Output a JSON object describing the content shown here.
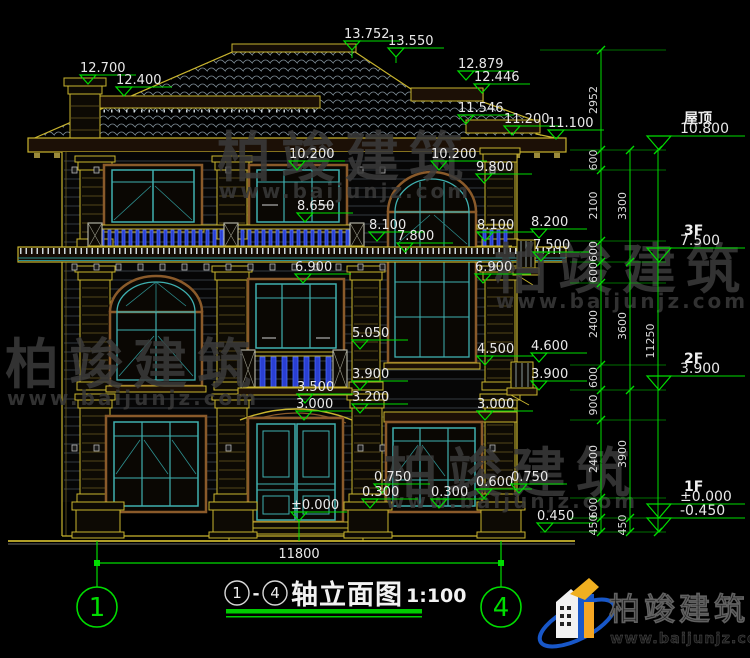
{
  "drawing": {
    "title_axis_start": "1",
    "title_axis_end": "4",
    "title_dash": "-",
    "title_text": "轴立面图",
    "scale": "1:100",
    "bottom_dimension": "11800",
    "axis_bubbles": [
      "1",
      "4"
    ]
  },
  "watermark_text": {
    "name": "柏竣建筑",
    "url": "www.baijunjz.com"
  },
  "logo": {
    "name": "柏竣建筑",
    "url": "www.baijunjz.com"
  },
  "floor_levels": [
    {
      "label": "屋顶",
      "value": "10.800",
      "y": 150
    },
    {
      "label": "3F",
      "value": "7.500",
      "y": 262
    },
    {
      "label": "2F",
      "value": "3.900",
      "y": 390
    },
    {
      "label": "1F",
      "value": "±0.000",
      "y": 518
    },
    {
      "label": "",
      "value": "-0.450",
      "y": 532
    }
  ],
  "elevation_markers": [
    {
      "value": "12.700",
      "x": 88,
      "y": 84
    },
    {
      "value": "12.400",
      "x": 124,
      "y": 96
    },
    {
      "value": "13.752",
      "x": 352,
      "y": 50,
      "tail": 8
    },
    {
      "value": "13.550",
      "x": 396,
      "y": 57,
      "tail": 6
    },
    {
      "value": "12.879",
      "x": 466,
      "y": 80
    },
    {
      "value": "12.446",
      "x": 482,
      "y": 93
    },
    {
      "value": "11.546",
      "x": 466,
      "y": 124
    },
    {
      "value": "11.200",
      "x": 512,
      "y": 135
    },
    {
      "value": "11.100",
      "x": 556,
      "y": 139
    },
    {
      "value": "10.200",
      "x": 297,
      "y": 170
    },
    {
      "value": "10.200",
      "x": 439,
      "y": 170
    },
    {
      "value": "9.800",
      "x": 484,
      "y": 183
    },
    {
      "value": "8.650",
      "x": 305,
      "y": 222
    },
    {
      "value": "8.100",
      "x": 377,
      "y": 241
    },
    {
      "value": "7.800",
      "x": 405,
      "y": 252
    },
    {
      "value": "8.100",
      "x": 485,
      "y": 241
    },
    {
      "value": "8.200",
      "x": 539,
      "y": 238
    },
    {
      "value": "7.500",
      "x": 541,
      "y": 261
    },
    {
      "value": "6.900",
      "x": 303,
      "y": 283
    },
    {
      "value": "6.900",
      "x": 483,
      "y": 283
    },
    {
      "value": "5.050",
      "x": 360,
      "y": 349
    },
    {
      "value": "3.900",
      "x": 360,
      "y": 390
    },
    {
      "value": "3.500",
      "x": 305,
      "y": 403
    },
    {
      "value": "3.200",
      "x": 360,
      "y": 413
    },
    {
      "value": "3.000",
      "x": 304,
      "y": 420
    },
    {
      "value": "4.500",
      "x": 485,
      "y": 365
    },
    {
      "value": "3.000",
      "x": 485,
      "y": 420
    },
    {
      "value": "4.600",
      "x": 539,
      "y": 362
    },
    {
      "value": "3.900",
      "x": 539,
      "y": 390
    },
    {
      "value": "0.750",
      "x": 382,
      "y": 493
    },
    {
      "value": "0.300",
      "x": 370,
      "y": 508
    },
    {
      "value": "0.300",
      "x": 439,
      "y": 508
    },
    {
      "value": "0.600",
      "x": 484,
      "y": 498
    },
    {
      "value": "0.750",
      "x": 519,
      "y": 493
    },
    {
      "value": "±0.000",
      "x": 299,
      "y": 521,
      "tail": 20
    },
    {
      "value": "0.450",
      "x": 545,
      "y": 532
    }
  ],
  "dim_chains": [
    {
      "x": 601,
      "segments": [
        {
          "label": "2952",
          "y1": 50,
          "y2": 150
        },
        {
          "label": "600",
          "y1": 150,
          "y2": 170
        },
        {
          "label": "2100",
          "y1": 170,
          "y2": 241
        },
        {
          "label": "600",
          "y1": 241,
          "y2": 262
        },
        {
          "label": "600",
          "y1": 262,
          "y2": 283
        },
        {
          "label": "2400",
          "y1": 283,
          "y2": 365
        },
        {
          "label": "600",
          "y1": 365,
          "y2": 390
        },
        {
          "label": "900",
          "y1": 390,
          "y2": 420
        },
        {
          "label": "2400",
          "y1": 420,
          "y2": 498
        },
        {
          "label": "600",
          "y1": 498,
          "y2": 518
        },
        {
          "label": "450",
          "y1": 518,
          "y2": 532
        }
      ]
    },
    {
      "x": 630,
      "segments": [
        {
          "label": "3300",
          "y1": 150,
          "y2": 262
        },
        {
          "label": "3600",
          "y1": 262,
          "y2": 390
        },
        {
          "label": "3900",
          "y1": 390,
          "y2": 518
        },
        {
          "label": "450",
          "y1": 518,
          "y2": 532
        }
      ]
    },
    {
      "x": 658,
      "segments": [
        {
          "label": "11250",
          "y1": 150,
          "y2": 532
        }
      ]
    }
  ],
  "watermarks": [
    {
      "x": 345,
      "y": 176,
      "uy": 198
    },
    {
      "x": 133,
      "y": 383,
      "uy": 405
    },
    {
      "x": 622,
      "y": 288,
      "uy": 308
    },
    {
      "x": 512,
      "y": 492,
      "uy": 508
    }
  ],
  "colors": {
    "dim_green": "#00dd00",
    "outline_yellow": "#c9b52e",
    "window_teal": "#3fb0b0",
    "trim_brown": "#8a5a2a",
    "baluster_blue": "#4a6cff",
    "siding_gray": "#454d54",
    "tile_gray": "#8a98a2",
    "watermark_gray": "#3b3b3b",
    "logo_blue": "#1857c8",
    "logo_orange": "#f0a020"
  }
}
